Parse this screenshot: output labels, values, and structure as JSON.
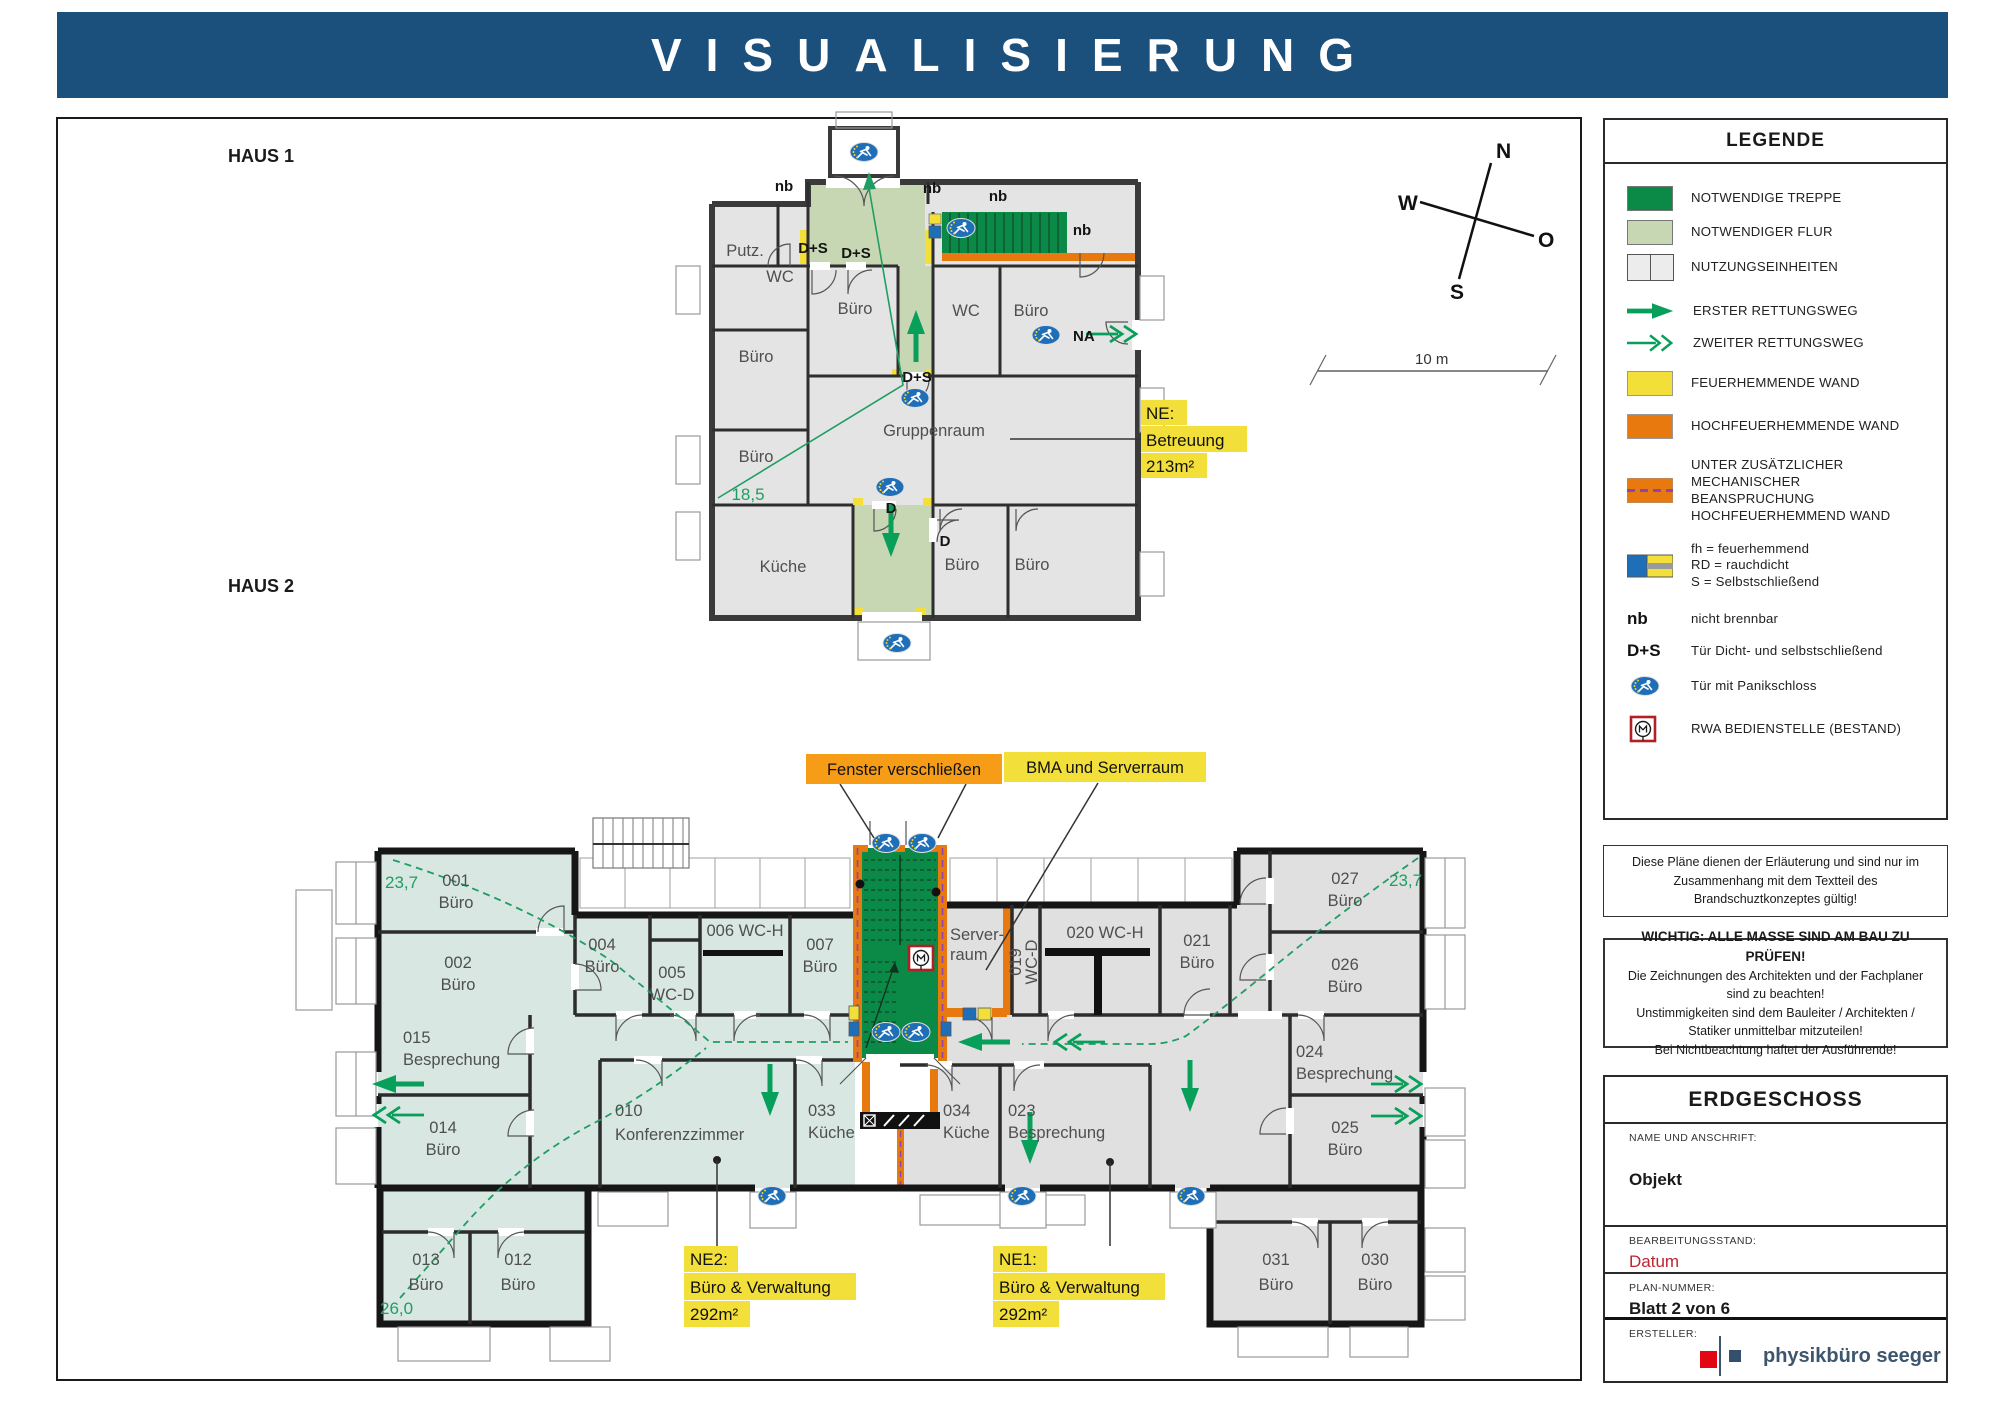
{
  "header": {
    "title": "VISUALISIERUNG"
  },
  "plan_area": {
    "haus1_label": "HAUS 1",
    "haus2_label": "HAUS 2"
  },
  "compass": {
    "n": "N",
    "w": "W",
    "s": "S",
    "o": "O"
  },
  "scale_bar": {
    "label": "10 m"
  },
  "haus1": {
    "rooms": {
      "putz": "Putz.",
      "wc_left": "WC",
      "buero_left1": "Büro",
      "buero_left2": "Büro",
      "buero_mid": "Büro",
      "wc_right": "WC",
      "buero_right": "Büro",
      "gruppenraum": "Gruppenraum",
      "kueche": "Küche",
      "buero_b1": "Büro",
      "buero_b2": "Büro"
    },
    "annotations": {
      "nb": "nb",
      "ds": "D+S",
      "d": "D",
      "na": "NA",
      "dim": "18,5"
    },
    "ne_callout": {
      "line1": "NE:",
      "line2": "Betreuung",
      "line3": "213m²"
    }
  },
  "haus2": {
    "rooms": {
      "r001": {
        "num": "001",
        "name": "Büro"
      },
      "r002": {
        "num": "002",
        "name": "Büro"
      },
      "r004": {
        "num": "004",
        "name": "Büro"
      },
      "r005": {
        "num": "005",
        "name": "WC-D"
      },
      "r006": {
        "label": "006 WC-H"
      },
      "r007": {
        "num": "007",
        "name": "Büro"
      },
      "server": {
        "line1": "Server-",
        "line2": "raum"
      },
      "r019": {
        "num": "019",
        "name": "WC-D"
      },
      "r020": {
        "label": "020 WC-H"
      },
      "r021": {
        "num": "021",
        "name": "Büro"
      },
      "r010": {
        "num": "010",
        "name": "Konferenzzimmer"
      },
      "r012": {
        "num": "012",
        "name": "Büro"
      },
      "r013": {
        "num": "013",
        "name": "Büro"
      },
      "r014": {
        "num": "014",
        "name": "Büro"
      },
      "r015": {
        "num": "015",
        "name": "Besprechung"
      },
      "r023": {
        "num": "023",
        "name": "Besprechung"
      },
      "r024": {
        "num": "024",
        "name": "Besprechung"
      },
      "r025": {
        "num": "025",
        "name": "Büro"
      },
      "r026": {
        "num": "026",
        "name": "Büro"
      },
      "r027": {
        "num": "027",
        "name": "Büro"
      },
      "r030": {
        "num": "030",
        "name": "Büro"
      },
      "r031": {
        "num": "031",
        "name": "Büro"
      },
      "r033": {
        "num": "033",
        "name": "Küche"
      },
      "r034": {
        "num": "034",
        "name": "Küche"
      }
    },
    "dims": {
      "left": "23,7",
      "right": "23,7",
      "bottom": "26,0"
    },
    "ne1": {
      "line1": "NE1:",
      "line2": "Büro & Verwaltung",
      "line3": "292m²"
    },
    "ne2": {
      "line1": "NE2:",
      "line2": "Büro & Verwaltung",
      "line3": "292m²"
    },
    "callouts": {
      "fenster": "Fenster verschließen",
      "bma": "BMA und Serverraum"
    }
  },
  "legend": {
    "title": "LEGENDE",
    "items": [
      {
        "label": "NOTWENDIGE TREPPE"
      },
      {
        "label": "NOTWENDIGER FLUR"
      },
      {
        "label": "NUTZUNGSEINHEITEN"
      },
      {
        "label": "ERSTER RETTUNGSWEG"
      },
      {
        "label": "ZWEITER RETTUNGSWEG"
      },
      {
        "label": "FEUERHEMMENDE WAND"
      },
      {
        "label": "HOCHFEUERHEMMENDE WAND"
      },
      {
        "label": "UNTER ZUSÄTZLICHER MECHANISCHER BEANSPRUCHUNG HOCHFEUERHEMMEND WAND"
      },
      {
        "label": "nicht brennbar"
      },
      {
        "label": "Tür Dicht- und selbstschließend"
      },
      {
        "label": "Tür mit Panikschloss"
      },
      {
        "label": "RWA BEDIENSTELLE (BESTAND)"
      }
    ],
    "fh_lines": [
      "fh = feuerhemmend",
      "RD = rauchdicht",
      "S = Selbstschließend"
    ],
    "keys": {
      "nb": "nb",
      "ds": "D+S"
    }
  },
  "notes": {
    "note1": "Diese Pläne dienen der Erläuterung und sind nur im Zusammenhang mit dem Textteil des Brandschuztkonzeptes gültig!",
    "note2_title": "WICHTIG: ALLE MASSE SIND AM BAU ZU PRÜFEN!",
    "note2_lines": [
      "Die Zeichnungen des Architekten und der Fachplaner sind zu beachten!",
      "Unstimmigkeiten sind dem Bauleiter / Architekten / Statiker unmittelbar mitzuteilen!",
      "Bei Nichtbeachtung haftet der Ausführende!"
    ]
  },
  "titleblock": {
    "title": "ERDGESCHOSS",
    "name_label": "NAME UND ANSCHRIFT:",
    "name_value": "Objekt",
    "status_label": "BEARBEITUNGSSTAND:",
    "status_value": "Datum",
    "plan_label": "PLAN-NUMMER:",
    "plan_value": "Blatt 2 von 6",
    "creator_label": "ERSTELLER:",
    "creator_value": "physikbüro seeger"
  },
  "colors": {
    "header_blue": "#1b4f7c",
    "treppe_green": "#0b8a47",
    "flur_green": "#c8d7b3",
    "arrow_green": "#079f59",
    "route_green": "#1f9e63",
    "wall_yellow": "#f2df3a",
    "wall_orange": "#e8790f",
    "callout_orange": "#f69c17",
    "panic_blue": "#1e6eb8",
    "purple_dash": "#8e44ad",
    "north_red": "#b5121b",
    "datum_red": "#c0242e",
    "brand_slate": "#3d566e"
  }
}
